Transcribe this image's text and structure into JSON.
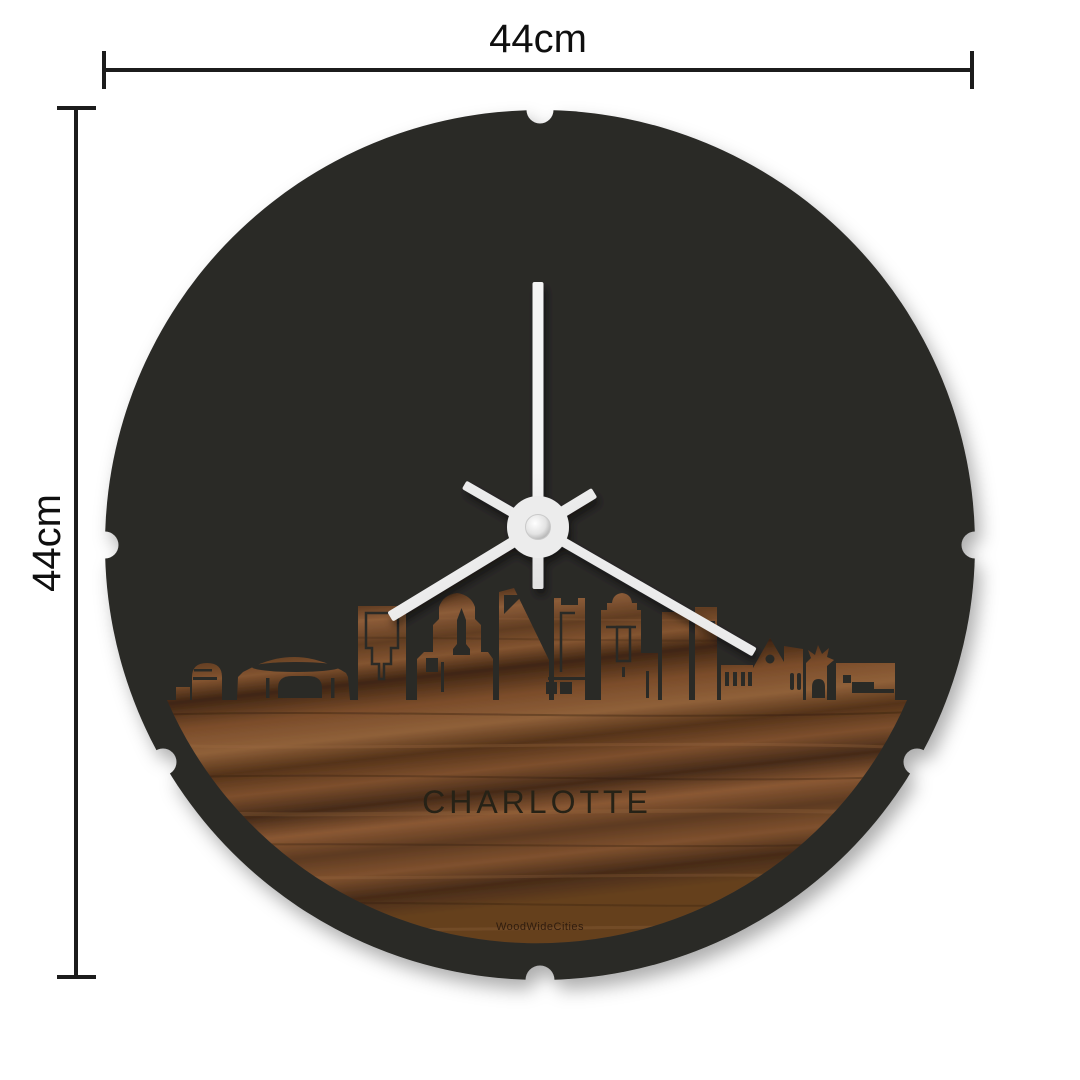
{
  "dimensions": {
    "width": {
      "label": "44cm"
    },
    "height": {
      "label": "44cm"
    },
    "line_color": "#1c1c1c"
  },
  "clock": {
    "city": "CHARLOTTE",
    "brand": "WoodWideCities",
    "face_color": "#2b2a28",
    "wood_light": "#8f6039",
    "wood_mid": "#6b4226",
    "wood_dark": "#3a2312",
    "hand_color": "#e9e9e9",
    "hub_color": "#ececec"
  }
}
